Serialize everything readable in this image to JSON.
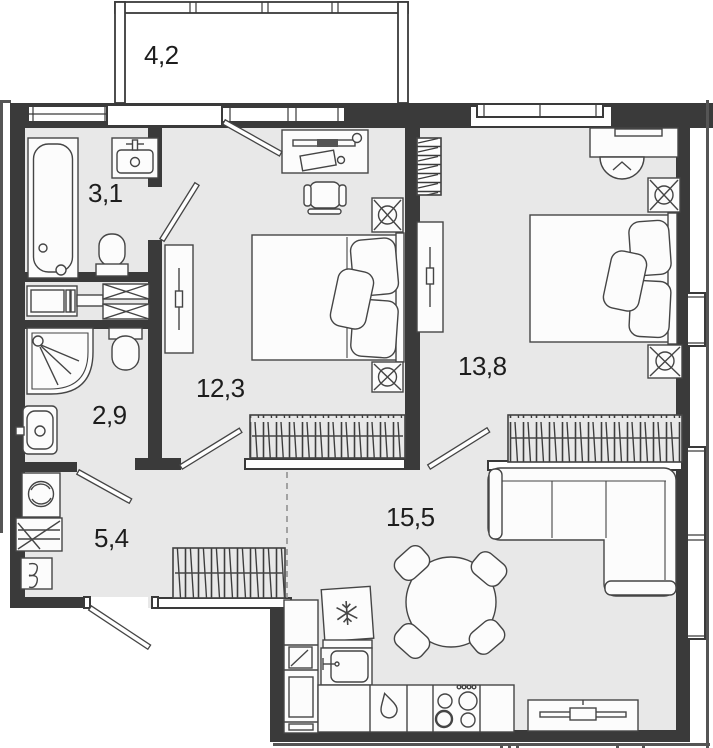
{
  "plan": {
    "rooms": [
      {
        "id": "balcony",
        "area": "4,2"
      },
      {
        "id": "bathroom",
        "area": "3,1"
      },
      {
        "id": "shower-room",
        "area": "2,9"
      },
      {
        "id": "hallway",
        "area": "5,4"
      },
      {
        "id": "bedroom-1",
        "area": "12,3"
      },
      {
        "id": "bedroom-2",
        "area": "13,8"
      },
      {
        "id": "living-kitchen",
        "area": "15,5"
      }
    ],
    "colors": {
      "wall": "#3a3a3a",
      "floor": "#e8e8e8",
      "furniture_outline": "#454545",
      "label": "#1d1d1d",
      "background": "#ffffff"
    }
  }
}
